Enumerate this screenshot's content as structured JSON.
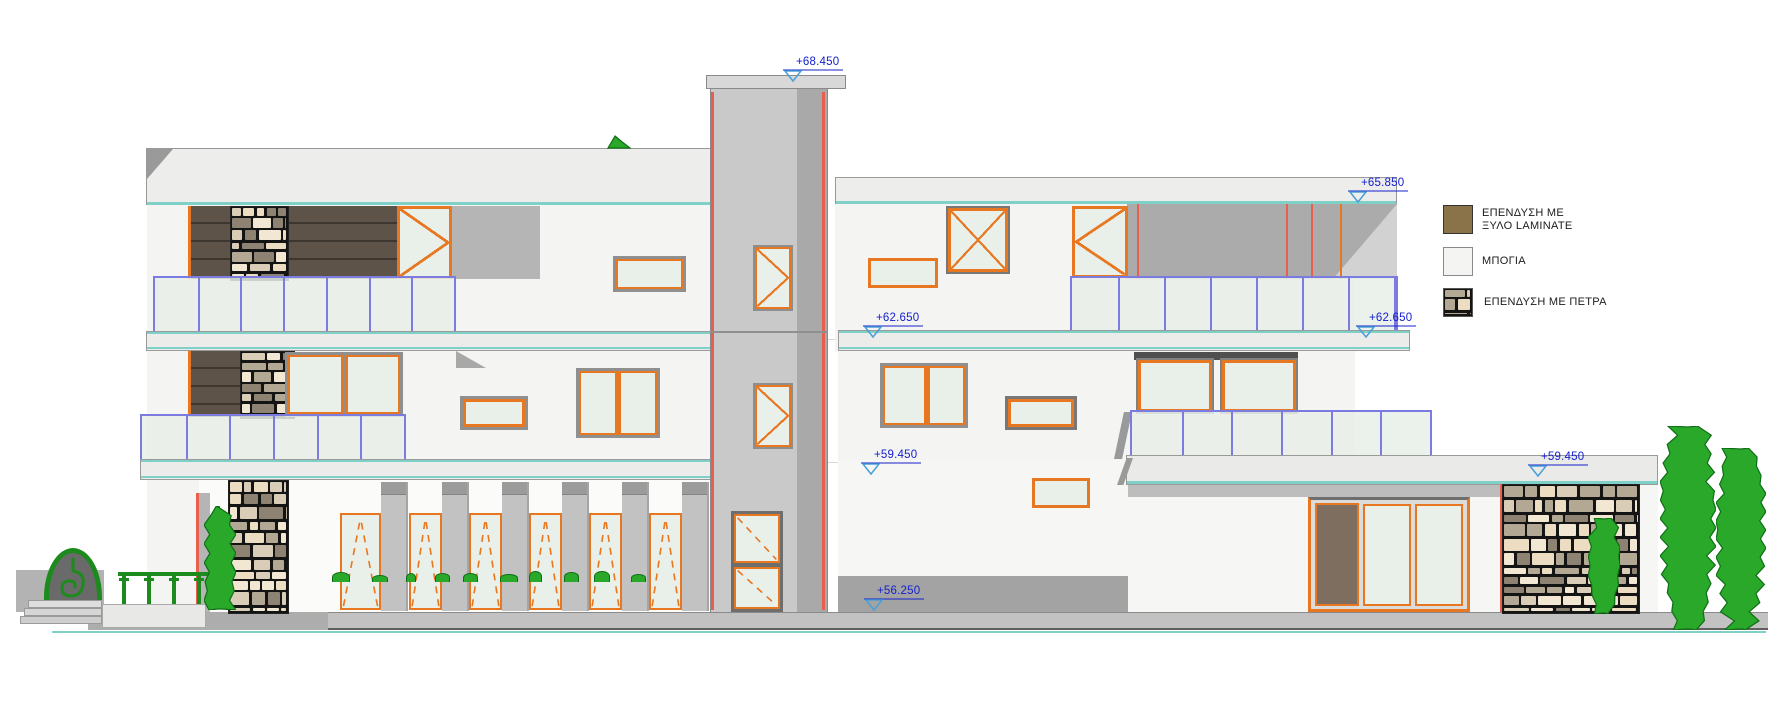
{
  "drawing": {
    "kind": "building-elevation"
  },
  "markers": {
    "m68": {
      "label": "+68.450"
    },
    "m65": {
      "label": "+65.850"
    },
    "m62c": {
      "label": "+62.650"
    },
    "m62r": {
      "label": "+62.650"
    },
    "m59c": {
      "label": "+59.450"
    },
    "m59r": {
      "label": "+59.450"
    },
    "m56": {
      "label": "+56.250"
    }
  },
  "legend": {
    "items": [
      {
        "id": "wood-laminate",
        "label_line1": "ΕΠΕΝΔΥΣΗ ΜΕ",
        "label_line2": "ΞΥΛΟ LAMINATE",
        "swatch_color": "#8a7349"
      },
      {
        "id": "paint",
        "label_line1": "ΜΠΟΓΙΑ",
        "label_line2": "",
        "swatch_color": "#f4f4f2"
      },
      {
        "id": "stone",
        "label_line1": "ΕΠΕΝΔΥΣΗ ΜΕ ΠΕΤΡΑ",
        "label_line2": "",
        "swatch_color": "pattern:stone"
      }
    ]
  },
  "colors": {
    "frame_orange": "#e87721",
    "accent_red": "#e8604d",
    "railing_blue": "#7b7be0",
    "slab_teal": "#7fd0c6",
    "marker_text_blue": "#1520cc",
    "marker_triangle_blue": "#4a9fd8",
    "wood_brown": "#5e5349",
    "plant_green": "#2aa82a",
    "glass": "#e9efe9",
    "stone_beige": "#f2e7d2"
  }
}
